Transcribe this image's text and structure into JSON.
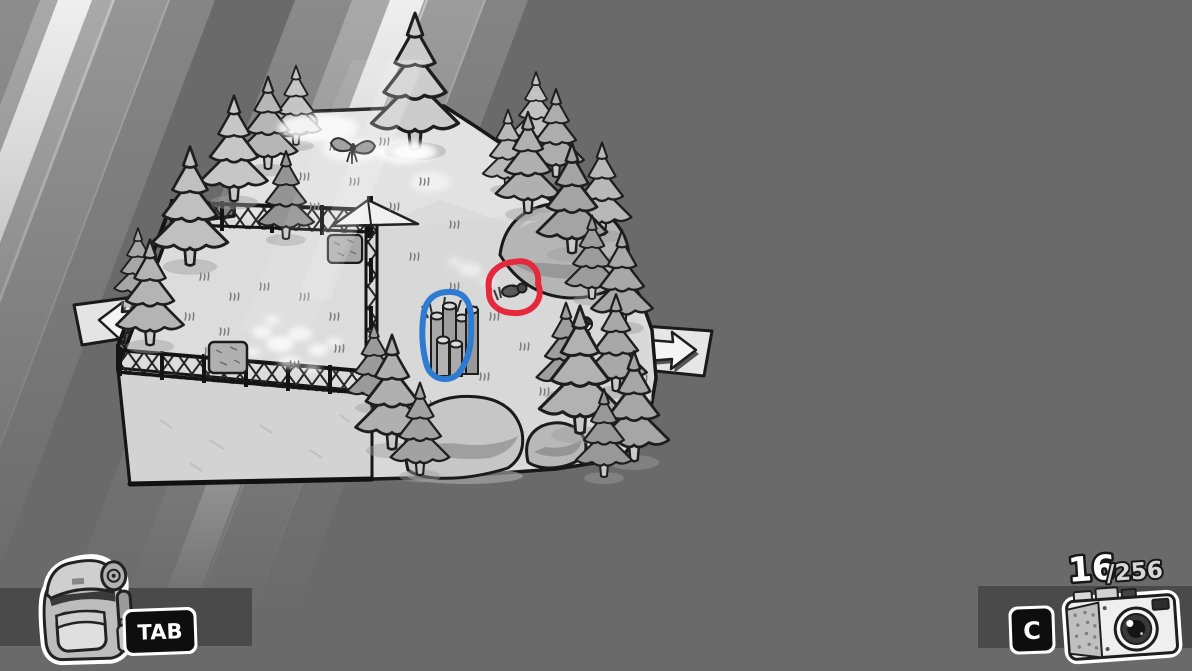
{
  "colors": {
    "background": "#6a6a6a",
    "hud_strip": "#4a4a4a",
    "key_bg": "#0e0e0e",
    "key_text": "#ffffff",
    "outline": "#1a1a1a",
    "terrain": "#dcdcdc"
  },
  "hud": {
    "inventory": {
      "key_label": "TAB",
      "icon": "backpack-icon"
    },
    "camera": {
      "key_label": "C",
      "icon": "camera-icon"
    },
    "film_counter": {
      "current": "16",
      "total": "/256"
    }
  },
  "annotations": {
    "red_circle": {
      "color": "#e5283b",
      "target": "bug"
    },
    "blue_circle": {
      "color": "#2e7cd1",
      "target": "log-pile"
    }
  },
  "scene": {
    "exits": {
      "left": "arrow-left-icon",
      "right": "arrow-right-icon"
    },
    "objects": [
      "light-beams",
      "fenced-platform",
      "lattice-fence",
      "pine-trees",
      "hay-bales",
      "tent",
      "rock-hill",
      "boulders",
      "log-pile",
      "bug",
      "butterfly",
      "hiker",
      "grass-tufts",
      "dappled-light"
    ]
  }
}
